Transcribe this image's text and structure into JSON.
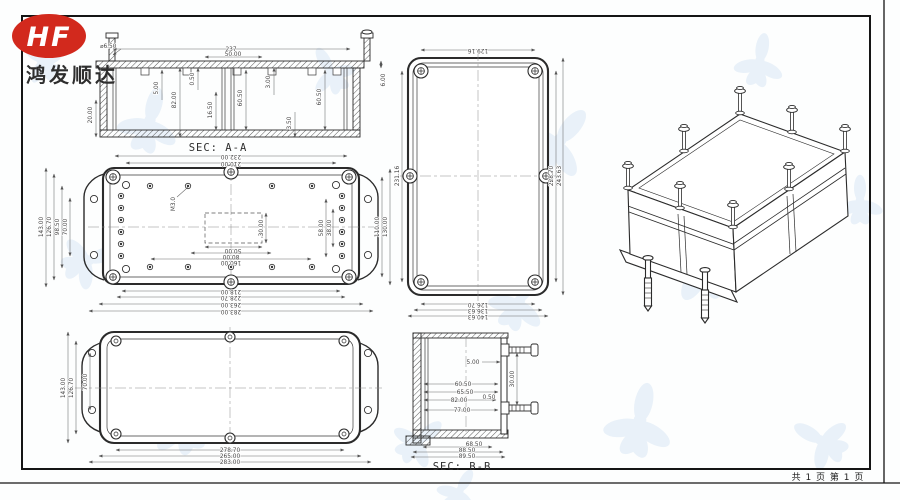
{
  "logo": {
    "monogram": "HF",
    "company": "鸿发顺达"
  },
  "footer": {
    "page_info": "共 1 页  第 1 页"
  },
  "colors": {
    "logo_red": "#d2291d",
    "line": "#2b2b2b",
    "dim_text": "#454545",
    "watermark": "#e2edf7"
  },
  "sec_aa": {
    "label": "SEC: A-A",
    "hole_dia": "⌀6.50",
    "top_width": "237",
    "top_inner": "50.00",
    "left_h": "20.00",
    "v1": "5.00",
    "v2": "82.00",
    "v3": "0.50",
    "v4": "16.50",
    "v5": "60.50",
    "v6": "3.00",
    "v7": "60.50",
    "v8": "3.50",
    "right_h": "6.00"
  },
  "plan_mid": {
    "top": [
      "232.00",
      "210.00"
    ],
    "bottom": [
      "218.00",
      "228.70",
      "263.00",
      "283.00"
    ],
    "left": [
      "143.00",
      "126.70",
      "98.50",
      "70.00"
    ],
    "right_outer": [
      "110.00",
      "130.00"
    ],
    "right_inner": [
      "58.00",
      "38.00"
    ],
    "cutout_w": "50.00",
    "cutout_h": "30.00",
    "holes_row1": "80.00",
    "holes_row2": "160.00",
    "thread_note": "M3.0"
  },
  "lid_plan": {
    "top": "129.16",
    "left": "231.16",
    "right": [
      "228.70",
      "243.63"
    ],
    "bottom": [
      "126.70",
      "136.63",
      "140.63"
    ]
  },
  "plan_bottom": {
    "left": [
      "143.00",
      "126.70",
      "70.00"
    ],
    "bottom": [
      "278.70",
      "265.00",
      "283.00"
    ]
  },
  "sec_bb": {
    "label": "SEC: B-B",
    "d1": "5.00",
    "d2": "60.50",
    "d3": "65.50",
    "d4": "82.00",
    "d5": "0.50",
    "d6": "77.00",
    "d7": "30.00",
    "bottom": [
      "68.50",
      "88.50",
      "89.50"
    ]
  }
}
